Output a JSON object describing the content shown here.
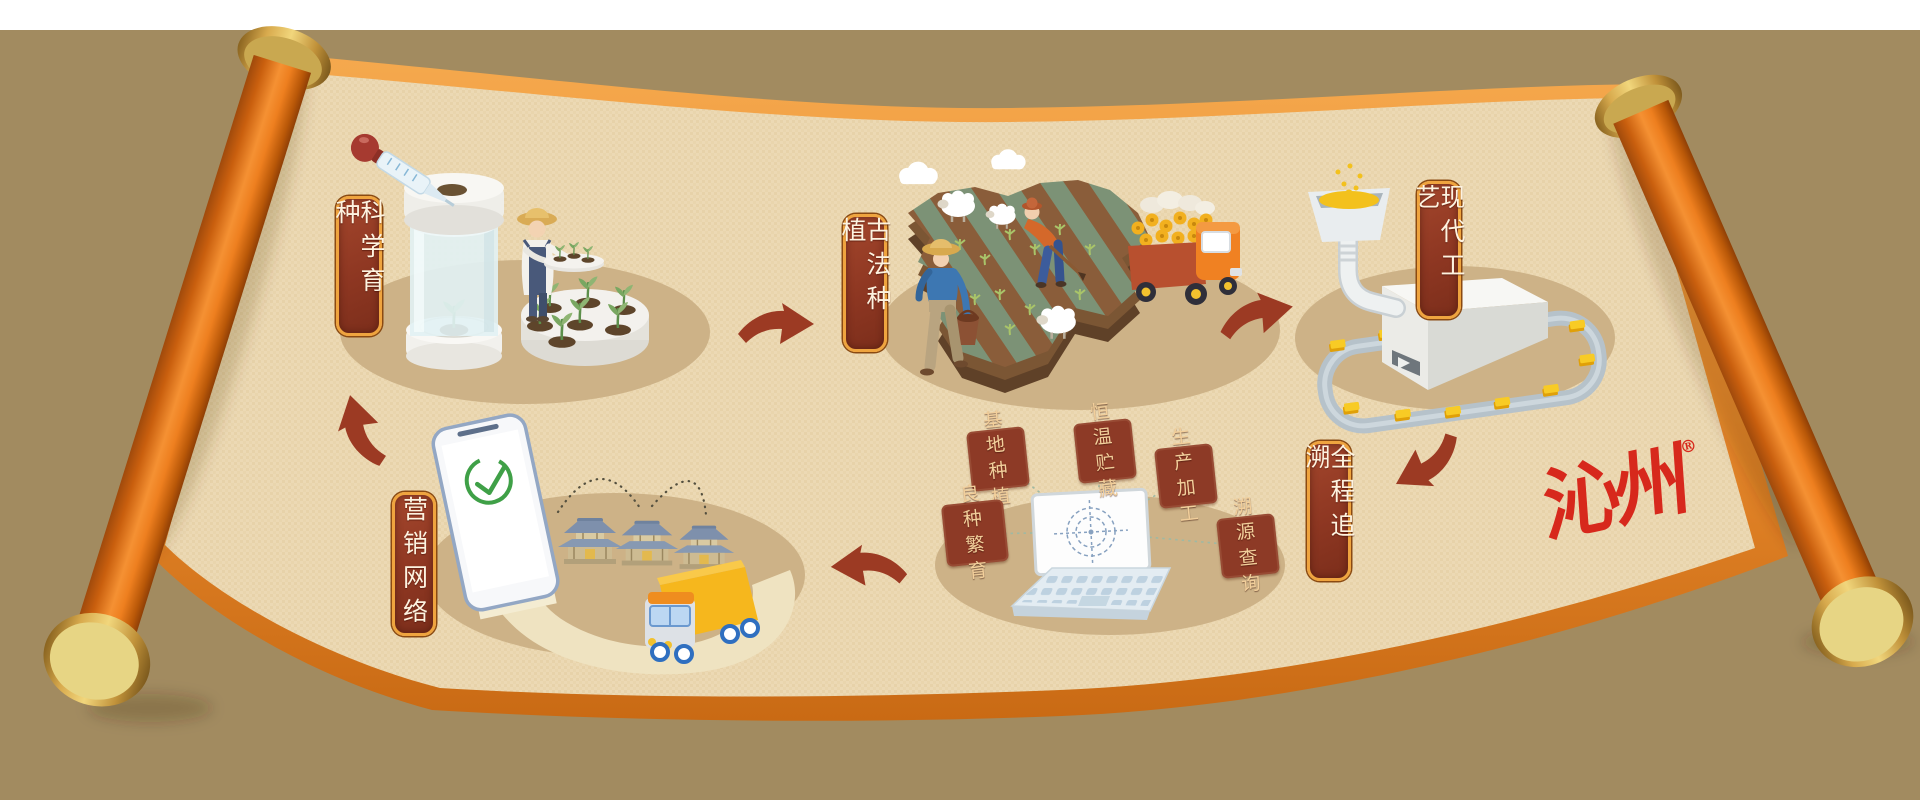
{
  "stages": [
    {
      "id": "scientific-breeding",
      "label": "科学育种"
    },
    {
      "id": "traditional-planting",
      "label": "古法种植"
    },
    {
      "id": "modern-processing",
      "label": "现代工艺"
    },
    {
      "id": "full-traceability",
      "label": "全程追溯"
    },
    {
      "id": "marketing-network",
      "label": "营销网络"
    }
  ],
  "trace_tags": [
    {
      "id": "base-planting",
      "label": "基地种植"
    },
    {
      "id": "constant-temp-storage",
      "label": "恒温贮藏"
    },
    {
      "id": "production-processing",
      "label": "生产加工"
    },
    {
      "id": "seed-breeding",
      "label": "良种繁育"
    },
    {
      "id": "trace-query",
      "label": "溯源查询"
    }
  ],
  "brand": {
    "logo_text": "沁州",
    "registered": "®"
  },
  "colors": {
    "backdrop_tan": "#a28b60",
    "parchment": "#ecd9b4",
    "scroll_border_orange": "#ea8c2e",
    "roller_orange": "#f59133",
    "gold_cap": "#e4ca72",
    "plaque_red": "#8e3722",
    "plaque_border_gold": "#efa43f",
    "tag_red": "#8d3a26",
    "tag_text_gold": "#f2cf9b",
    "arrow_red": "#9c3a23",
    "logo_red": "#d7281c",
    "stage_shadow": "#cdb287",
    "check_green": "#3fa047"
  }
}
